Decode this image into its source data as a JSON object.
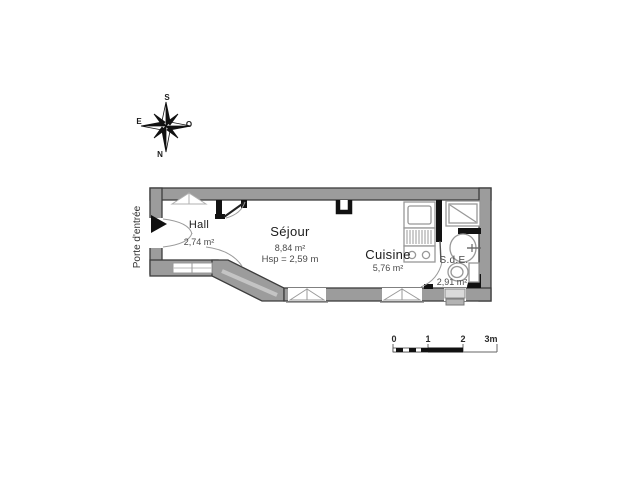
{
  "compass": {
    "top": "S",
    "right": "O",
    "bottom": "N",
    "left": "E"
  },
  "entrance": {
    "label": "Porte d'entrée"
  },
  "rooms": {
    "hall": {
      "name": "Hall",
      "area": "2,74 m²"
    },
    "sejour": {
      "name": "Séjour",
      "area": "8,84 m²",
      "height": "Hsp = 2,59 m"
    },
    "cuisine": {
      "name": "Cuisine",
      "area": "5,76 m²"
    },
    "sde": {
      "name": "S.d.E.",
      "area": "2,91 m²"
    }
  },
  "scale_bar": {
    "ticks": [
      "0",
      "1",
      "2",
      "3m"
    ]
  },
  "colors": {
    "background": "#ffffff",
    "wall_fill": "#9c9c9c",
    "wall_stroke": "#3d3d3d",
    "partition": "#121212",
    "fixture_stroke": "#989898",
    "arc_stroke": "#9a9a9a",
    "text_primary": "#1c1c1c",
    "text_secondary": "#4a4a4a"
  }
}
